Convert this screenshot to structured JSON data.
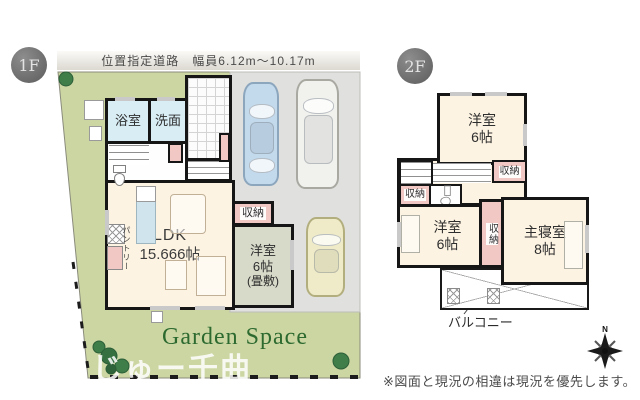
{
  "colors": {
    "garden_green": "#cbd6a2",
    "driveway_gray": "#e0e0de",
    "room_cream": "#fdf3e2",
    "water_blue": "#d9edf5",
    "tatami_green": "#d7d9c9",
    "closet_pink": "#f2c8c4",
    "wall_black": "#161616",
    "garden_text_green": "#2d6a30",
    "badge_gray": "#6e6e6e"
  },
  "floor1": {
    "badge": "1F",
    "road_label": "位置指定道路　幅員6.12m〜10.17m",
    "garden_label": "Garden Space",
    "bath": "浴室",
    "washroom": "洗面",
    "ldk_name": "LDK",
    "ldk_size": "15.666帖",
    "pantry": "パントリー",
    "storage": "収納",
    "tatami_name": "洋室",
    "tatami_size": "6帖",
    "tatami_note": "(畳敷)"
  },
  "floor2": {
    "badge": "2F",
    "north_room_name": "洋室",
    "north_room_size": "6帖",
    "storage_hall": "収納",
    "storage_left": "収納",
    "storage_center": "収納",
    "west_room_name": "洋室",
    "west_room_size": "6帖",
    "master_name": "主寝室",
    "master_size": "8帖",
    "balcony": "バルコニー"
  },
  "footer": {
    "disclaimer": "※図面と現況の相違は現況を優先します。",
    "compass_north": "N"
  },
  "watermark": "じゅー千曲"
}
